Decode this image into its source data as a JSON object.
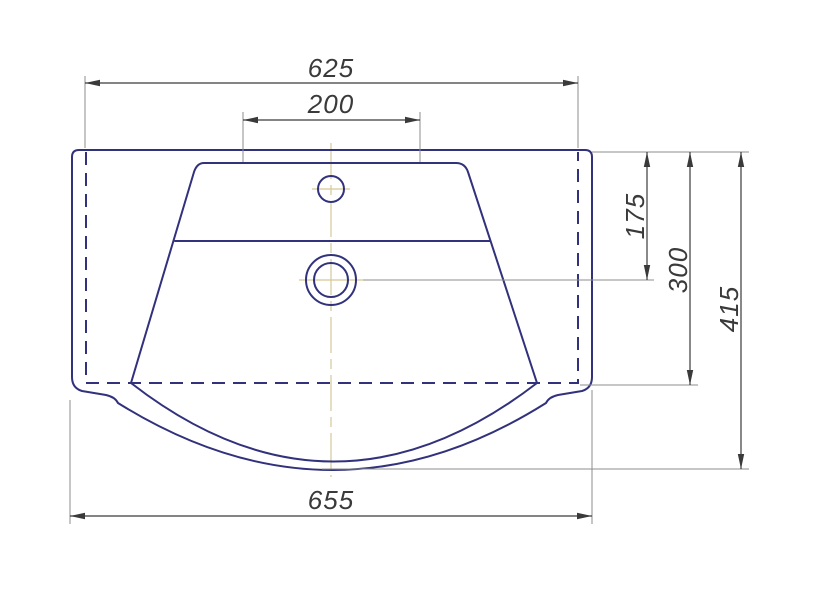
{
  "drawing": {
    "type": "technical-drawing",
    "subject": "washbasin-top-view",
    "units": "mm"
  },
  "colors": {
    "background": "#ffffff",
    "outline": "#31317c",
    "dimension": "#3a3a3a",
    "extension": "#8c8c8c",
    "centerline": "#d5c896",
    "text": "#3a3a3a"
  },
  "dimensions": {
    "rear_width": "625",
    "faucet_zone_width": "200",
    "drain_from_rear": "175",
    "body_depth": "300",
    "overall_depth": "415",
    "overall_width": "655"
  }
}
